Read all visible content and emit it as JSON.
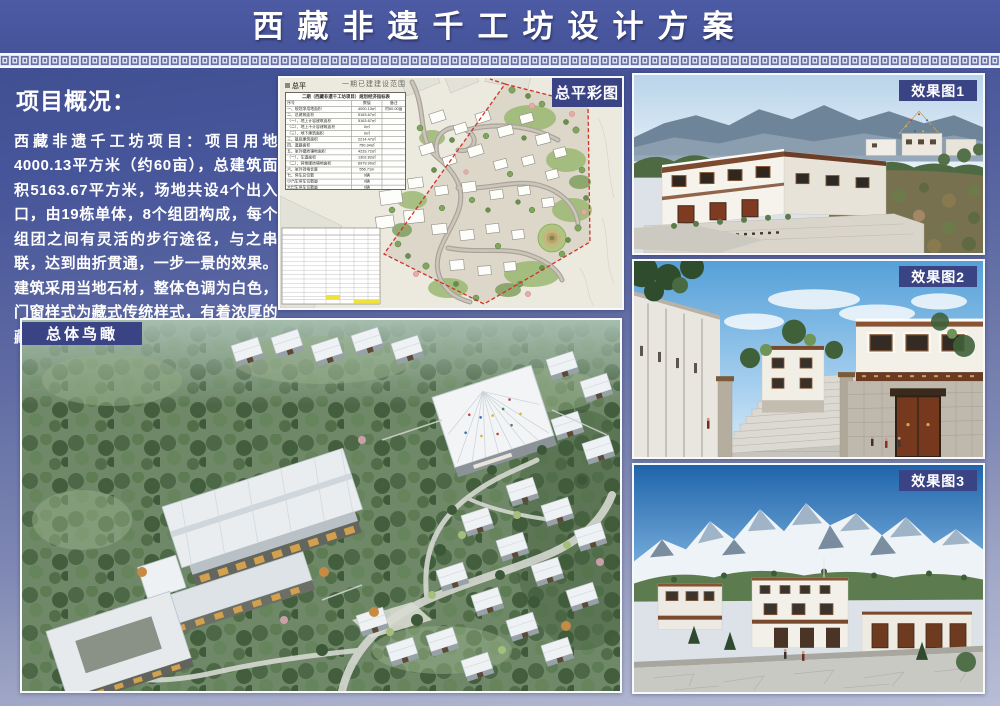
{
  "header": {
    "title": "西藏非遗千工坊设计方案"
  },
  "overview": {
    "heading": "项目概况：",
    "body": "西藏非遗千工坊项目：项目用地4000.13平方米（约60亩），总建筑面积5163.67平方米，场地共设4个出入口，由19栋单体，8个组团构成，每个组团之间有灵活的步行途径，与之串联，达到曲折贯通，一步一景的效果。建筑采用当地石材，整体色调为白色，门窗样式为藏式传统样式，有着浓厚的藏式风味，符合片区的整体风貌。"
  },
  "panels": {
    "site_plan": {
      "label": "总平彩图",
      "note_top": "一期已建建设范围",
      "corner_mark": "总平",
      "table": {
        "title": "二期（西藏非遗千工坊项目）规划经济指标表",
        "columns": [
          "序号",
          "数值",
          "备注"
        ],
        "rows": [
          [
            "一、规划净用地面积",
            "4000.13㎡",
            "约60.00亩"
          ],
          [
            "二、总建筑面积",
            "5163.67㎡",
            ""
          ],
          [
            "（一）、地上计容建筑面积",
            "5163.67㎡",
            ""
          ],
          [
            "（二）、地上不计容建筑面积",
            "0㎡",
            ""
          ],
          [
            "（三）、地下建筑面积",
            "0㎡",
            ""
          ],
          [
            "三、基底建筑面积",
            "2214.47㎡",
            ""
          ],
          [
            "四、道路面积",
            "750.34㎡",
            ""
          ],
          [
            "五、室外硬质铺地面积",
            "4233.72㎡",
            ""
          ],
          [
            "（一）、车道面积",
            "1302.82㎡",
            ""
          ],
          [
            "（二）、其他硬质铺地面积",
            "6979.90㎡",
            ""
          ],
          [
            "六、室外挡墙长度",
            "556.71m",
            ""
          ],
          [
            "七、停车总位数",
            "0辆",
            ""
          ],
          [
            "小汽车停车位数量",
            "0辆",
            ""
          ],
          [
            "大巴车停车位数量",
            "0辆",
            ""
          ]
        ]
      }
    },
    "renders": [
      {
        "label": "效果图1"
      },
      {
        "label": "效果图2"
      },
      {
        "label": "效果图3"
      }
    ],
    "aerial": {
      "label": "总体鸟瞰"
    }
  },
  "colors": {
    "title_bar": "#45539a",
    "label_box": "#3a4384",
    "background_top": "#3d4c8e",
    "background_bottom": "#b8bed6",
    "boundary_red": "#d23127"
  }
}
